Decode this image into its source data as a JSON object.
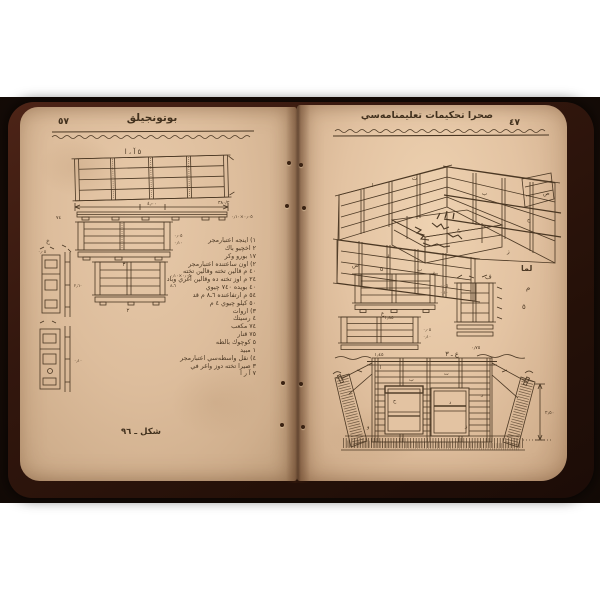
{
  "colors": {
    "photo_bg": "#1a0e08",
    "cover": "#33170e",
    "page": "#e3c3a2",
    "ink": "#4a3723",
    "white": "#ffffff"
  },
  "left_page": {
    "page_number": "٧٥",
    "header": "بوتونجيلق",
    "diagram_top_label": "٥ آ ، ا",
    "caption": "شكل ـ ٦٩",
    "dims": {
      "main_width": "٤٫٠٠",
      "right_mark": "٣٨٠/٢",
      "left_mark": "٧٤",
      "plank_section": "٠٫٠٥×٠٫١٠",
      "small_1": "٠٫٠٥",
      "small_2": "٠٫١٠",
      "small_3": "٦ـ٨",
      "panel_b_num": "٣",
      "panel_c_num": "٢",
      "side_label": "خ",
      "side_dim": "٢٫٦٠"
    },
    "legend": [
      "١) اينجه اعتبارمجر",
      "٢ اخچيو باك",
      "١٧ بورو وكر",
      "٢) اون ساعتنده اعتبارمجر",
      "٤٠ م قالين تخته وقالين تخته",
      "٢٤ م اوز تخته ده وقالين آغري وباد",
      "٤٠ بويده ٧٤٠ چيوي",
      "٥٤ م ارتفاعنده ٦ـ٨ م قد",
      "٥٠ كيلو چيوي ٤ م",
      "٣) اروات",
      "٤ رسيتك",
      "٧٤ مكعب",
      "٧٥ قنار",
      "٥ كوچوك بالطه",
      "١ مبيد",
      "٤) نقل واسطه‌سي اعتبارمجر",
      "٣ صيرا تخته دوز واغر في",
      "٧ آ ر ا"
    ]
  },
  "right_page": {
    "page_number": "٧٤",
    "header": "صحرا تحكيمات تعليمنامه‌سي",
    "perspective": {
      "letters": [
        "ا",
        "ب",
        "ت",
        "ح",
        "خ",
        "د",
        "ر",
        "ز",
        "س",
        "ص"
      ],
      "bottom_small": "٥",
      "bottom_f": "ف",
      "margin_bold": "لما",
      "margin_mid": "م",
      "margin_small": "٥"
    },
    "panels": {
      "d_label": "ب",
      "d_dim": "١٫٨٥",
      "e_label": "ع",
      "e_dim": "١٫٤٥",
      "f_dim": "٠٫٧٥",
      "col_small_1": "٠٫٠٥",
      "col_small_2": "٠٫١٠"
    },
    "section": {
      "title": "ع ـ ٣",
      "depth": "٢٫٥٠",
      "letters": [
        "ا",
        "ب",
        "ت",
        "ح",
        "د",
        "ر",
        "و",
        "ز"
      ]
    }
  }
}
